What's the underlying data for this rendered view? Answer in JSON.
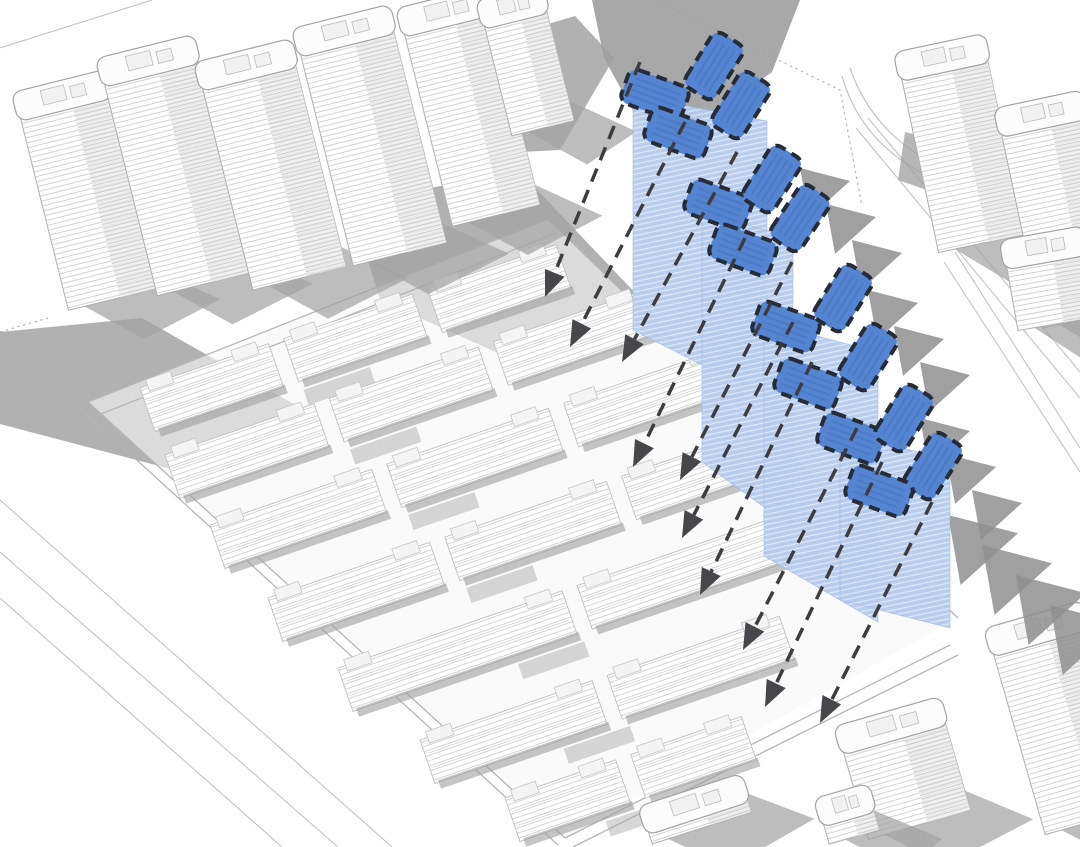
{
  "canvas": {
    "w": 1080,
    "h": 847
  },
  "palette": {
    "background": "#ffffff",
    "linework": "#c3c3c3",
    "linework_dark": "#adadad",
    "boundary": "#b5b5b5",
    "shadow_blob": "#9e9e9e",
    "shadow_triangle": "#8f8f8f",
    "row_shadow": "#9f9f9f",
    "tower_shadow": "#a3a3a3",
    "roof_fill": "#5585d0",
    "roof_stripe": "#4c7ac8",
    "roof_border": "#252c38",
    "facade_fill": "#b5cbec",
    "facade_stripe": "#dde7f6",
    "dash_line": "#3c3c41",
    "arrow_fill": "#46464b",
    "site_ground": "#f7f7f7"
  },
  "roads": {
    "thin": [
      [
        0,
        48,
        152,
        0
      ],
      [
        856,
        128,
        1080,
        398
      ],
      [
        868,
        118,
        1080,
        372
      ],
      [
        944,
        262,
        1080,
        472
      ],
      [
        955,
        252,
        1080,
        448
      ],
      [
        0,
        500,
        392,
        847
      ],
      [
        0,
        552,
        338,
        847
      ],
      [
        0,
        598,
        282,
        847
      ]
    ],
    "curves": [
      "M 842 76 Q 868 168 988 198 L 1080 206",
      "M 850 68 Q 880 156 992 187 L 1080 195"
    ],
    "dotted": [
      "M 655 0 L 840 90 L 862 206",
      "M 0 332 L 48 318"
    ]
  },
  "shadow_blobs": [
    {
      "points": [
        [
          592,
          0
        ],
        [
          800,
          0
        ],
        [
          772,
          72
        ],
        [
          700,
          124
        ],
        [
          638,
          120
        ],
        [
          604,
          58
        ]
      ],
      "opacity": 0.9
    },
    {
      "points": [
        [
          420,
          62
        ],
        [
          575,
          16
        ],
        [
          614,
          58
        ],
        [
          560,
          150
        ],
        [
          440,
          156
        ]
      ],
      "opacity": 0.8
    },
    {
      "points": [
        [
          350,
          202
        ],
        [
          520,
          172
        ],
        [
          642,
          300
        ],
        [
          518,
          362
        ],
        [
          380,
          300
        ]
      ],
      "opacity": 0.8
    },
    {
      "points": [
        [
          0,
          332
        ],
        [
          142,
          318
        ],
        [
          322,
          420
        ],
        [
          182,
          472
        ],
        [
          0,
          424
        ]
      ],
      "opacity": 0.8
    },
    {
      "points": [
        [
          905,
          132
        ],
        [
          1010,
          158
        ],
        [
          990,
          212
        ],
        [
          898,
          180
        ]
      ],
      "opacity": 0.75
    }
  ],
  "site": {
    "ground": [
      [
        88,
        402
      ],
      [
        548,
        219
      ],
      [
        958,
        618
      ],
      [
        565,
        838
      ]
    ],
    "boundary": [
      [
        88,
        402,
        548,
        219
      ],
      [
        96,
        416,
        556,
        233
      ],
      [
        88,
        402,
        565,
        838
      ],
      [
        81,
        409,
        558,
        845
      ],
      [
        565,
        838,
        950,
        645
      ],
      [
        573,
        847,
        958,
        655
      ],
      [
        548,
        219,
        958,
        618
      ]
    ],
    "row_angle": -19,
    "row_height": 46,
    "row_gap": 16,
    "rows": [
      {
        "x": 140,
        "y": 388,
        "len": 440,
        "segs": 3
      },
      {
        "x": 165,
        "y": 455,
        "len": 505,
        "segs": 3
      },
      {
        "x": 210,
        "y": 525,
        "len": 545,
        "segs": 3
      },
      {
        "x": 268,
        "y": 598,
        "len": 545,
        "segs": 3
      },
      {
        "x": 338,
        "y": 668,
        "len": 490,
        "segs": 2
      },
      {
        "x": 420,
        "y": 740,
        "len": 380,
        "segs": 2
      },
      {
        "x": 505,
        "y": 798,
        "len": 250,
        "segs": 2
      }
    ]
  },
  "context_towers": [
    {
      "x": 14,
      "y": 92,
      "w": 92,
      "h": 225,
      "rot": -14
    },
    {
      "x": 98,
      "y": 58,
      "w": 96,
      "h": 245,
      "rot": -14
    },
    {
      "x": 196,
      "y": 62,
      "w": 96,
      "h": 235,
      "rot": -14
    },
    {
      "x": 294,
      "y": 28,
      "w": 96,
      "h": 245,
      "rot": -14
    },
    {
      "x": 398,
      "y": 8,
      "w": 90,
      "h": 225,
      "rot": -14
    },
    {
      "x": 478,
      "y": 0,
      "w": 64,
      "h": 140,
      "rot": -14
    },
    {
      "x": 896,
      "y": 52,
      "w": 88,
      "h": 205,
      "rot": -12
    },
    {
      "x": 996,
      "y": 108,
      "w": 86,
      "h": 225,
      "rot": -12
    },
    {
      "x": 1002,
      "y": 240,
      "w": 80,
      "h": 92,
      "rot": -10
    },
    {
      "x": 986,
      "y": 628,
      "w": 98,
      "h": 215,
      "rot": -16
    },
    {
      "x": 836,
      "y": 726,
      "w": 106,
      "h": 118,
      "rot": -16
    },
    {
      "x": 640,
      "y": 806,
      "w": 104,
      "h": 40,
      "rot": -18
    },
    {
      "x": 816,
      "y": 798,
      "w": 52,
      "h": 48,
      "rot": -16
    }
  ],
  "shadow_triangles": {
    "shape": [
      [
        0,
        0
      ],
      [
        50,
        13
      ],
      [
        9,
        50
      ]
    ],
    "sets": [
      {
        "x": 800,
        "y": 168,
        "n": 3,
        "dx": 26,
        "dy": 36,
        "scale": 1.0
      },
      {
        "x": 868,
        "y": 290,
        "n": 3,
        "dx": 26,
        "dy": 36,
        "scale": 1.0
      },
      {
        "x": 920,
        "y": 418,
        "n": 3,
        "dx": 26,
        "dy": 36,
        "scale": 1.0
      },
      {
        "x": 948,
        "y": 515,
        "n": 4,
        "dx": 34,
        "dy": 30,
        "scale": 1.4
      }
    ]
  },
  "highlight": {
    "facade_bands": [
      {
        "points": [
          [
            633,
            96
          ],
          [
            767,
            121
          ],
          [
            767,
            398
          ],
          [
            633,
            330
          ]
        ]
      },
      {
        "points": [
          [
            702,
            212
          ],
          [
            793,
            238
          ],
          [
            793,
            528
          ],
          [
            702,
            462
          ]
        ]
      },
      {
        "points": [
          [
            764,
            322
          ],
          [
            878,
            352
          ],
          [
            878,
            622
          ],
          [
            764,
            556
          ]
        ]
      },
      {
        "points": [
          [
            840,
            432
          ],
          [
            950,
            460
          ],
          [
            950,
            628
          ],
          [
            840,
            600
          ]
        ]
      }
    ],
    "roof_size": {
      "w": 64,
      "h": 36,
      "rx": 9
    },
    "roofs": [
      {
        "x": 655,
        "y": 95,
        "rot": 20
      },
      {
        "x": 714,
        "y": 66,
        "rot": -58
      },
      {
        "x": 678,
        "y": 133,
        "rot": 20
      },
      {
        "x": 741,
        "y": 105,
        "rot": -58
      },
      {
        "x": 718,
        "y": 205,
        "rot": 20
      },
      {
        "x": 772,
        "y": 179,
        "rot": -58
      },
      {
        "x": 800,
        "y": 218,
        "rot": -56
      },
      {
        "x": 743,
        "y": 250,
        "rot": 20
      },
      {
        "x": 786,
        "y": 327,
        "rot": 20
      },
      {
        "x": 843,
        "y": 298,
        "rot": -58
      },
      {
        "x": 868,
        "y": 357,
        "rot": -58
      },
      {
        "x": 808,
        "y": 384,
        "rot": 20
      },
      {
        "x": 851,
        "y": 438,
        "rot": 20
      },
      {
        "x": 904,
        "y": 418,
        "rot": -58
      },
      {
        "x": 933,
        "y": 466,
        "rot": -58
      },
      {
        "x": 879,
        "y": 491,
        "rot": 20
      }
    ]
  },
  "view_arrows": [
    [
      640,
      62,
      545,
      297
    ],
    [
      685,
      122,
      570,
      347
    ],
    [
      737,
      152,
      622,
      362
    ],
    [
      745,
      238,
      633,
      467
    ],
    [
      792,
      262,
      680,
      480
    ],
    [
      793,
      322,
      682,
      538
    ],
    [
      812,
      362,
      700,
      595
    ],
    [
      857,
      428,
      743,
      650
    ],
    [
      882,
      462,
      765,
      707
    ],
    [
      932,
      502,
      820,
      723
    ]
  ]
}
